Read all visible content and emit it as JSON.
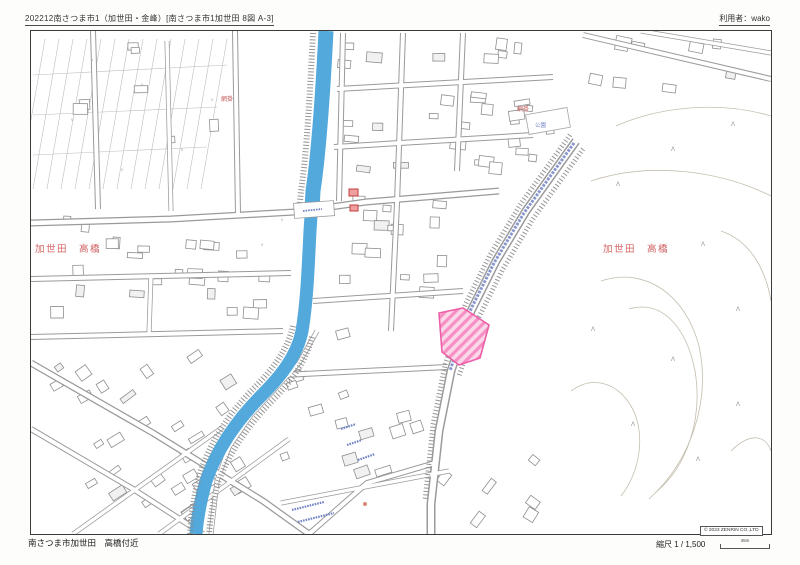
{
  "header": {
    "map_title": "202212南さつま市1（加世田・金峰）[南さつま市1加世田 8図 A-3]",
    "user_label": "利用者：wako"
  },
  "map": {
    "district_label_left": "加世田　高橋",
    "district_label_right": "加世田　高橋",
    "place_label_amikake_west": "網掛",
    "place_label_amikake_east": "網掛",
    "park_label": "公園",
    "symbols": {
      "vegetation": "Λ",
      "field": "v"
    },
    "colors": {
      "river": "#53a9dc",
      "highlight_parcel_fill": "#fbd7ea",
      "highlight_parcel_stripe": "#f78fc4",
      "highlight_parcel_border": "#ec5fa8",
      "district_text": "#d06060",
      "blue_label": "#7283c5"
    }
  },
  "footer": {
    "area_caption": "南さつま市加世田　高橋付近",
    "scale_label": "縮尺 1 / 1,500",
    "scale_bar_label": "45m",
    "copyright": "© 2023 ZENRIN CO.,LTD"
  }
}
